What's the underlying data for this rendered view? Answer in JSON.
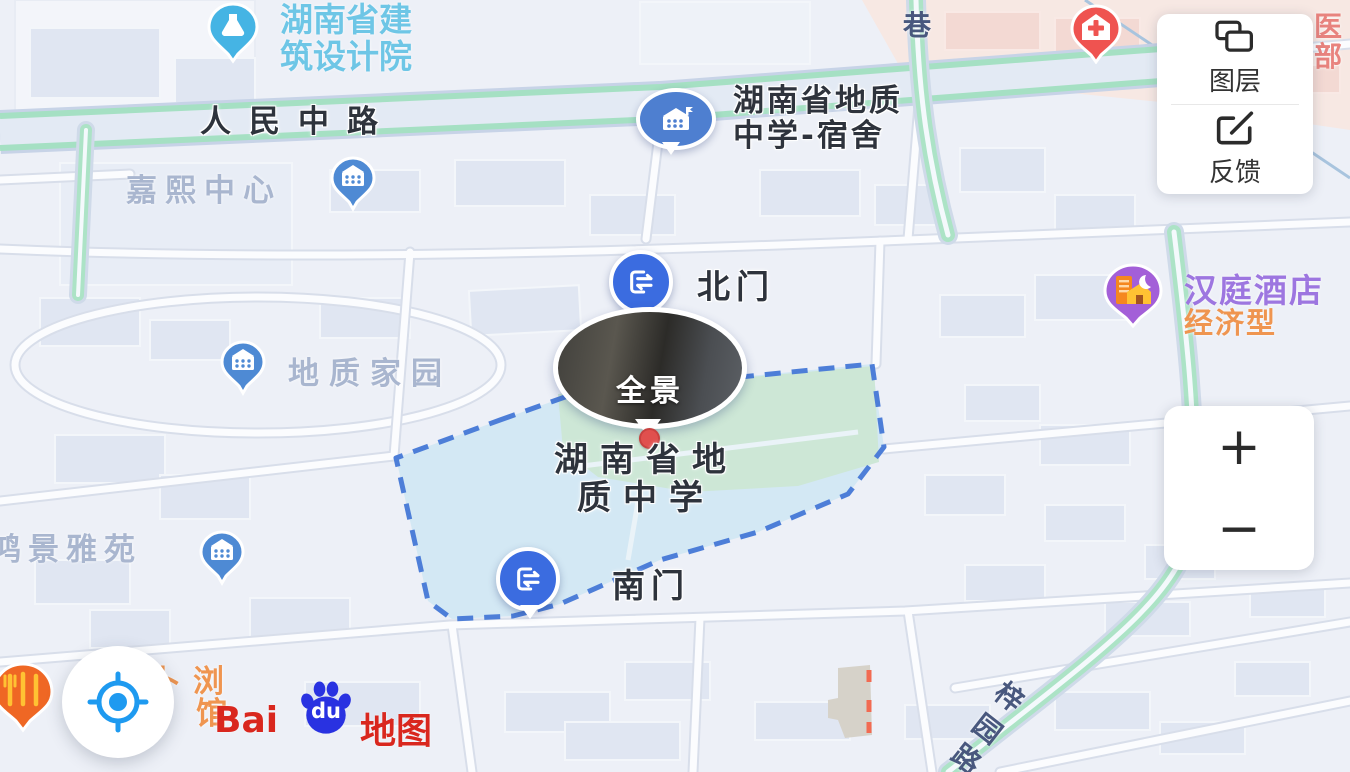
{
  "pois": {
    "design_institute": {
      "line1": "湖南省建",
      "line2": "筑设计院"
    },
    "jiaxi_center": "嘉熙中心",
    "geology_dorm": {
      "line1": "湖南省地质",
      "line2": "中学-宿舍"
    },
    "north_gate": "北门",
    "panorama": "全景",
    "geology_school": {
      "line1": "湖南省地",
      "line2": "质中学"
    },
    "south_gate": "南门",
    "geology_home": "地质家园",
    "hongjing_yayuan": "鸿景雅苑",
    "hanting_hotel": {
      "name": "汉庭酒店",
      "category": "经济型"
    },
    "hospital_partial": {
      "char_top": "医",
      "char_bottom": "部"
    },
    "restaurant_partial": {
      "line1": "卜浏",
      "line2": "馆"
    }
  },
  "roads": {
    "renmin_middle_road": "人民中路",
    "alley": "巷",
    "ziyuan_road": {
      "c0": "梓",
      "c1": "园",
      "c2": "路"
    }
  },
  "controls": {
    "layers_label": "图层",
    "feedback_label": "反馈",
    "zoom_in_label": "+",
    "zoom_out_label": "−"
  },
  "logo": {
    "bai": "Bai",
    "du": "du",
    "map_word": "地图"
  },
  "colors": {
    "poi_pin_blue": "#4e8ad4",
    "gate_blue": "#3b6ce0",
    "boundary_blue": "#4d7ed8",
    "campus_fill": "#d3e8f4",
    "field_green": "#cde7d6",
    "hotel_purple": "#a35fd8",
    "hospital_red": "#ef5350",
    "baidu_red": "#d9271e",
    "baidu_blue": "#2932e1",
    "locate_blue": "#1e9af0"
  }
}
